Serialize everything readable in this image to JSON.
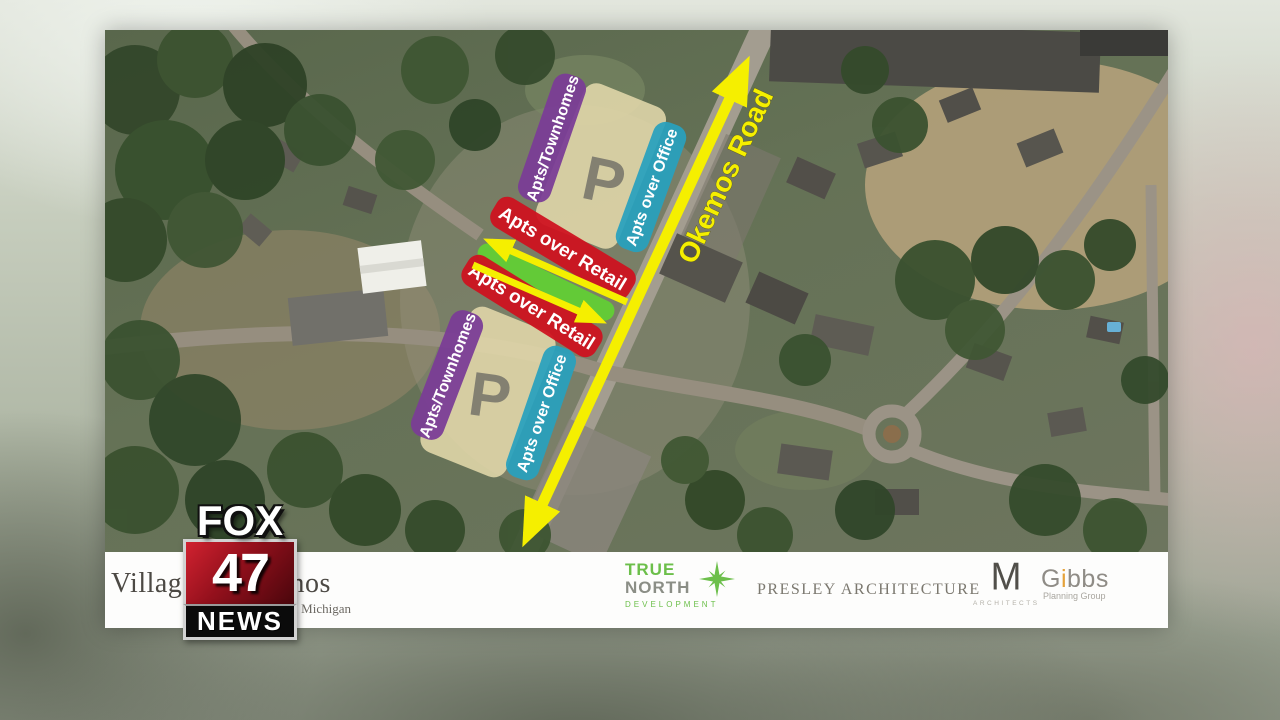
{
  "station": {
    "brand_top": "FOX",
    "brand_number": "47",
    "brand_bottom": "NEWS"
  },
  "map": {
    "road_label": "Okemos Road",
    "labels": {
      "townhomes": "Apts/Townhomes",
      "office": "Apts over Office",
      "retail": "Apts over Retail",
      "parking": "P"
    },
    "colors": {
      "townhomes": "#7a3d96",
      "office": "#28a0bd",
      "retail": "#ce121f",
      "mixed_green": "#62cf35",
      "parking_fill": "#e3d9ab",
      "highlight_yellow": "#f5ef00"
    }
  },
  "footer": {
    "client_name": "Village of Okemos",
    "client_region": "Michigan",
    "true_north": {
      "line1": "TRUE",
      "line2": "NORTH",
      "sub": "DEVELOPMENT"
    },
    "presley": "PRESLEY ARCHITECTURE",
    "m_architects": {
      "mark": "M",
      "sub": "ARCHITECTS"
    },
    "gibbs": {
      "g": "G",
      "i": "i",
      "rest": "bbs",
      "sub": "Planning Group"
    }
  }
}
